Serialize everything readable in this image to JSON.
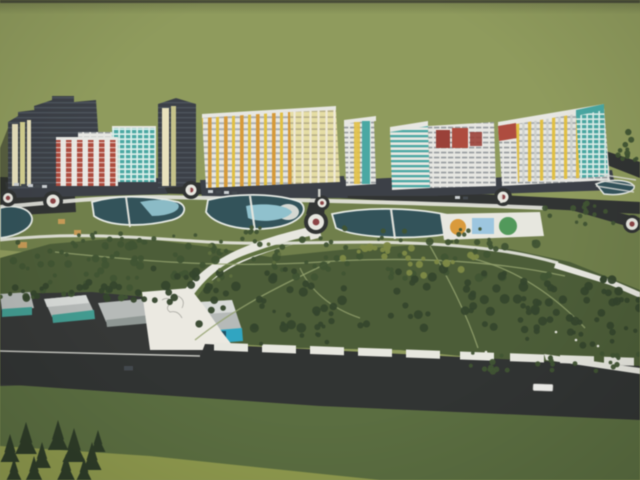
{
  "image": {
    "width": 640,
    "height": 480
  },
  "scene": {
    "kind": "photograph-of-architectural-rendering",
    "description": "Aerial 3D masterplan rendering: a row of colorful mid-rise apartment blocks along a boulevard, landscaped park with curved ponds, beach pools and sports courts, a white promenade, warehouse strip and a wide highway at the bottom, all on an olive-green backdrop.",
    "elements": [
      "apartment-buildings",
      "main-street",
      "roundabouts",
      "ponds",
      "swim-areas",
      "sports-courts",
      "park",
      "white-promenade",
      "warehouses",
      "highway",
      "bus",
      "fir-trees"
    ]
  },
  "colors": {
    "backdrop": "#8f9c5a",
    "backdrop_top": "#53573f",
    "lawn": "#6f7f48",
    "park": "#4b5d35",
    "field": "#5a6e3e",
    "field_light": "#95a04b",
    "road": "#2f3231",
    "asphalt": "#343736",
    "path": "#e9e9e1",
    "plaza": "#edebe3",
    "water_dark": "#30525a",
    "water_light": "#8fc3cf",
    "pond_rim": "#e8ece6",
    "rb_center": "#8e4244",
    "court_orange": "#dd9a35",
    "court_blue": "#9cc8e2",
    "court_green": "#4f9a58",
    "tree_dark": "#33452a",
    "tree_mid": "#3e5330",
    "tree_light": "#5d6f3c",
    "tree_yellow": "#7e8a42",
    "fir": "#2c3b26",
    "shadow": "#2a2e26",
    "tower_dark": "#3a3f46",
    "win_dark_row": "#596169",
    "stripe_cream": "#eae3bc",
    "stripe_yellow": "#d6d28e",
    "facade_white": "#e9e9e4",
    "window_dark": "#6e757b",
    "teal": "#46aaa4",
    "teal_light": "#ddf0ec",
    "teal_bright": "#2ba7c4",
    "yellow": "#e4c13e",
    "orange": "#da9a34",
    "pale_yellow": "#e8dfa2",
    "pale_win": "#aaa17b",
    "red": "#b24a3c",
    "maroon": "#9e3f36",
    "roof_gray": "#b7bbb9",
    "roof_light": "#d9dcd9",
    "warehouse_teal": "#3f9d92",
    "door_blue": "#1b4f66",
    "kiosk_tan": "#c99a52",
    "kiosk_green": "#c6d06a",
    "vehicle_white": "#f2f2ee",
    "car_dark": "#42484d",
    "car_light": "#ccd1d4",
    "path_thin": "#93a26b",
    "sketch": "#9a9a90"
  },
  "trees": {
    "clusters": [
      {
        "x": 60,
        "y": 238,
        "w": 500,
        "h": 42,
        "n": 90,
        "rmin": 2,
        "rmax": 4.5,
        "color": "tree_mid",
        "seed": 1
      },
      {
        "x": 150,
        "y": 268,
        "w": 390,
        "h": 62,
        "n": 85,
        "rmin": 2.5,
        "rmax": 5,
        "color": "tree_dark",
        "seed": 2
      },
      {
        "x": 0,
        "y": 240,
        "w": 140,
        "h": 58,
        "n": 40,
        "rmin": 2,
        "rmax": 4,
        "color": "tree_mid",
        "seed": 3
      },
      {
        "x": 340,
        "y": 244,
        "w": 140,
        "h": 32,
        "n": 26,
        "rmin": 2,
        "rmax": 4,
        "color": "tree_yellow",
        "seed": 4
      },
      {
        "x": 520,
        "y": 278,
        "w": 120,
        "h": 72,
        "n": 48,
        "rmin": 2,
        "rmax": 4.5,
        "color": "tree_dark",
        "seed": 5
      },
      {
        "x": 470,
        "y": 350,
        "w": 170,
        "h": 22,
        "n": 26,
        "rmin": 1.8,
        "rmax": 3.4,
        "color": "tree_mid",
        "seed": 6
      },
      {
        "x": 0,
        "y": 282,
        "w": 150,
        "h": 18,
        "n": 24,
        "rmin": 2,
        "rmax": 4,
        "color": "tree_dark",
        "seed": 7
      },
      {
        "x": 612,
        "y": 132,
        "w": 28,
        "h": 46,
        "n": 12,
        "rmin": 1.8,
        "rmax": 3.2,
        "color": "tree_mid",
        "seed": 8
      },
      {
        "x": 545,
        "y": 203,
        "w": 70,
        "h": 28,
        "n": 15,
        "rmin": 1.6,
        "rmax": 3,
        "color": "tree_mid",
        "seed": 9
      },
      {
        "x": 238,
        "y": 300,
        "w": 95,
        "h": 45,
        "n": 12,
        "rmin": 1.6,
        "rmax": 3,
        "color": "tree_dark",
        "seed": 10
      },
      {
        "x": 60,
        "y": 226,
        "w": 460,
        "h": 16,
        "n": 30,
        "rmin": 1.4,
        "rmax": 2.6,
        "color": "tree_mid",
        "seed": 11
      },
      {
        "x": 196,
        "y": 244,
        "w": 110,
        "h": 48,
        "n": 10,
        "rmin": 1.4,
        "rmax": 2.4,
        "color": "tree_light",
        "seed": 12
      }
    ]
  },
  "firs": {
    "items": [
      {
        "x": 10,
        "y": 462,
        "s": 28
      },
      {
        "x": 26,
        "y": 454,
        "s": 32
      },
      {
        "x": 42,
        "y": 468,
        "s": 26
      },
      {
        "x": 58,
        "y": 450,
        "s": 30
      },
      {
        "x": 74,
        "y": 462,
        "s": 34
      },
      {
        "x": 92,
        "y": 470,
        "s": 28
      },
      {
        "x": 34,
        "y": 480,
        "s": 24
      },
      {
        "x": 66,
        "y": 480,
        "s": 26
      },
      {
        "x": 98,
        "y": 452,
        "s": 22
      },
      {
        "x": 14,
        "y": 480,
        "s": 22
      },
      {
        "x": 84,
        "y": 480,
        "s": 22
      }
    ]
  }
}
